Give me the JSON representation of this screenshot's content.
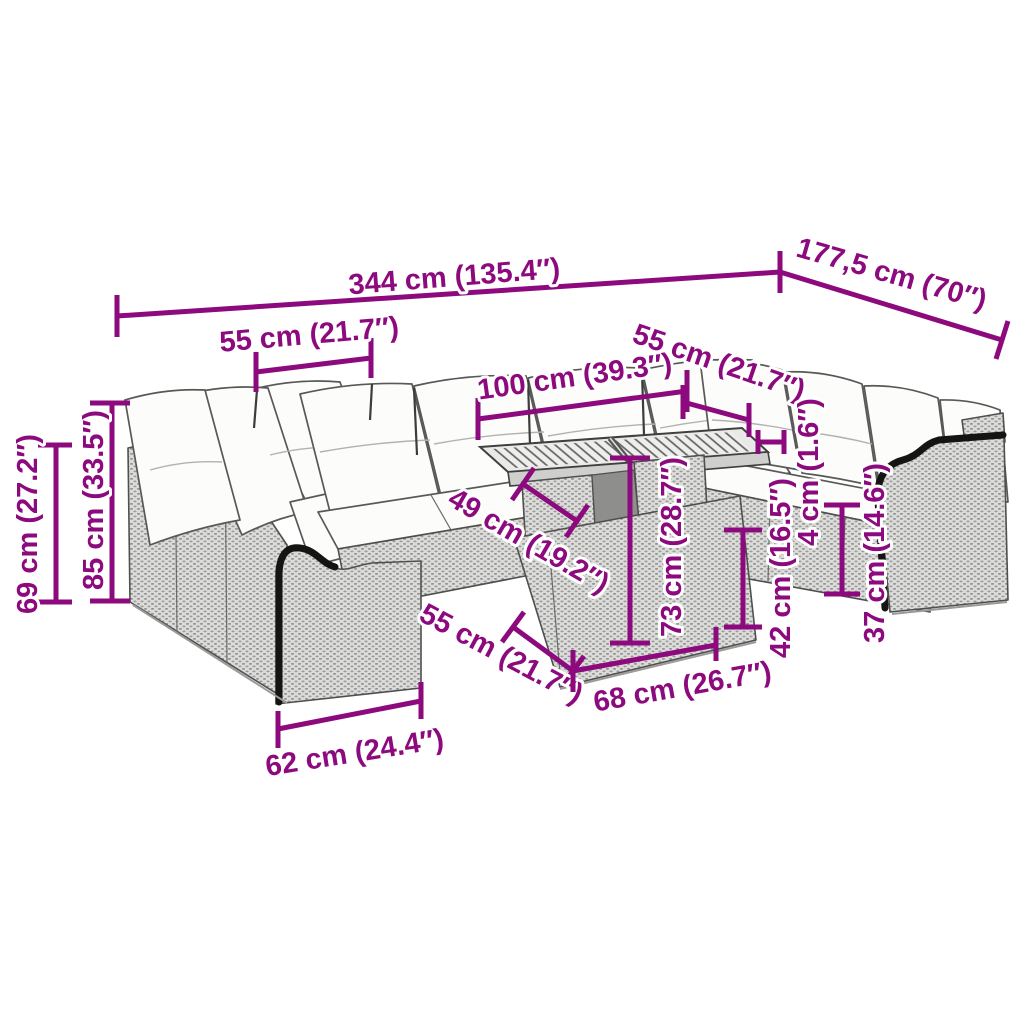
{
  "diagram": {
    "title": "Garden lounge set with table - dimension diagram",
    "labels": {
      "total_width": "344 cm (135.4″)",
      "total_depth": "177,5 cm (70″)",
      "left_seat_width": "55 cm (21.7″)",
      "right_seat_depth": "55 cm (21.7″)",
      "table_top_length": "100 cm (39.3″)",
      "table_top_depth": "49 cm (19.2″)",
      "table_height": "73 cm (28.7″)",
      "cushion_thickness": "4 cm (1.6″)",
      "seat_height": "42 cm (16.5″)",
      "armrest_height": "37 cm (14.6″)",
      "table_base_depth": "55 cm (21.7″)",
      "table_base_length": "68 cm (26.7″)",
      "armrest_width": "62 cm (24.4″)",
      "backrest_height": "69 cm (27.2″)",
      "total_height": "85 cm (33.5″)"
    },
    "colors": {
      "dimension_line": "#8C0A7D",
      "outline": "#4f4f4f",
      "wicker_fill": "#dcdcda",
      "wicker_dot": "#989896",
      "cushion_fill": "#fcfcfa",
      "background": "#ffffff"
    }
  }
}
